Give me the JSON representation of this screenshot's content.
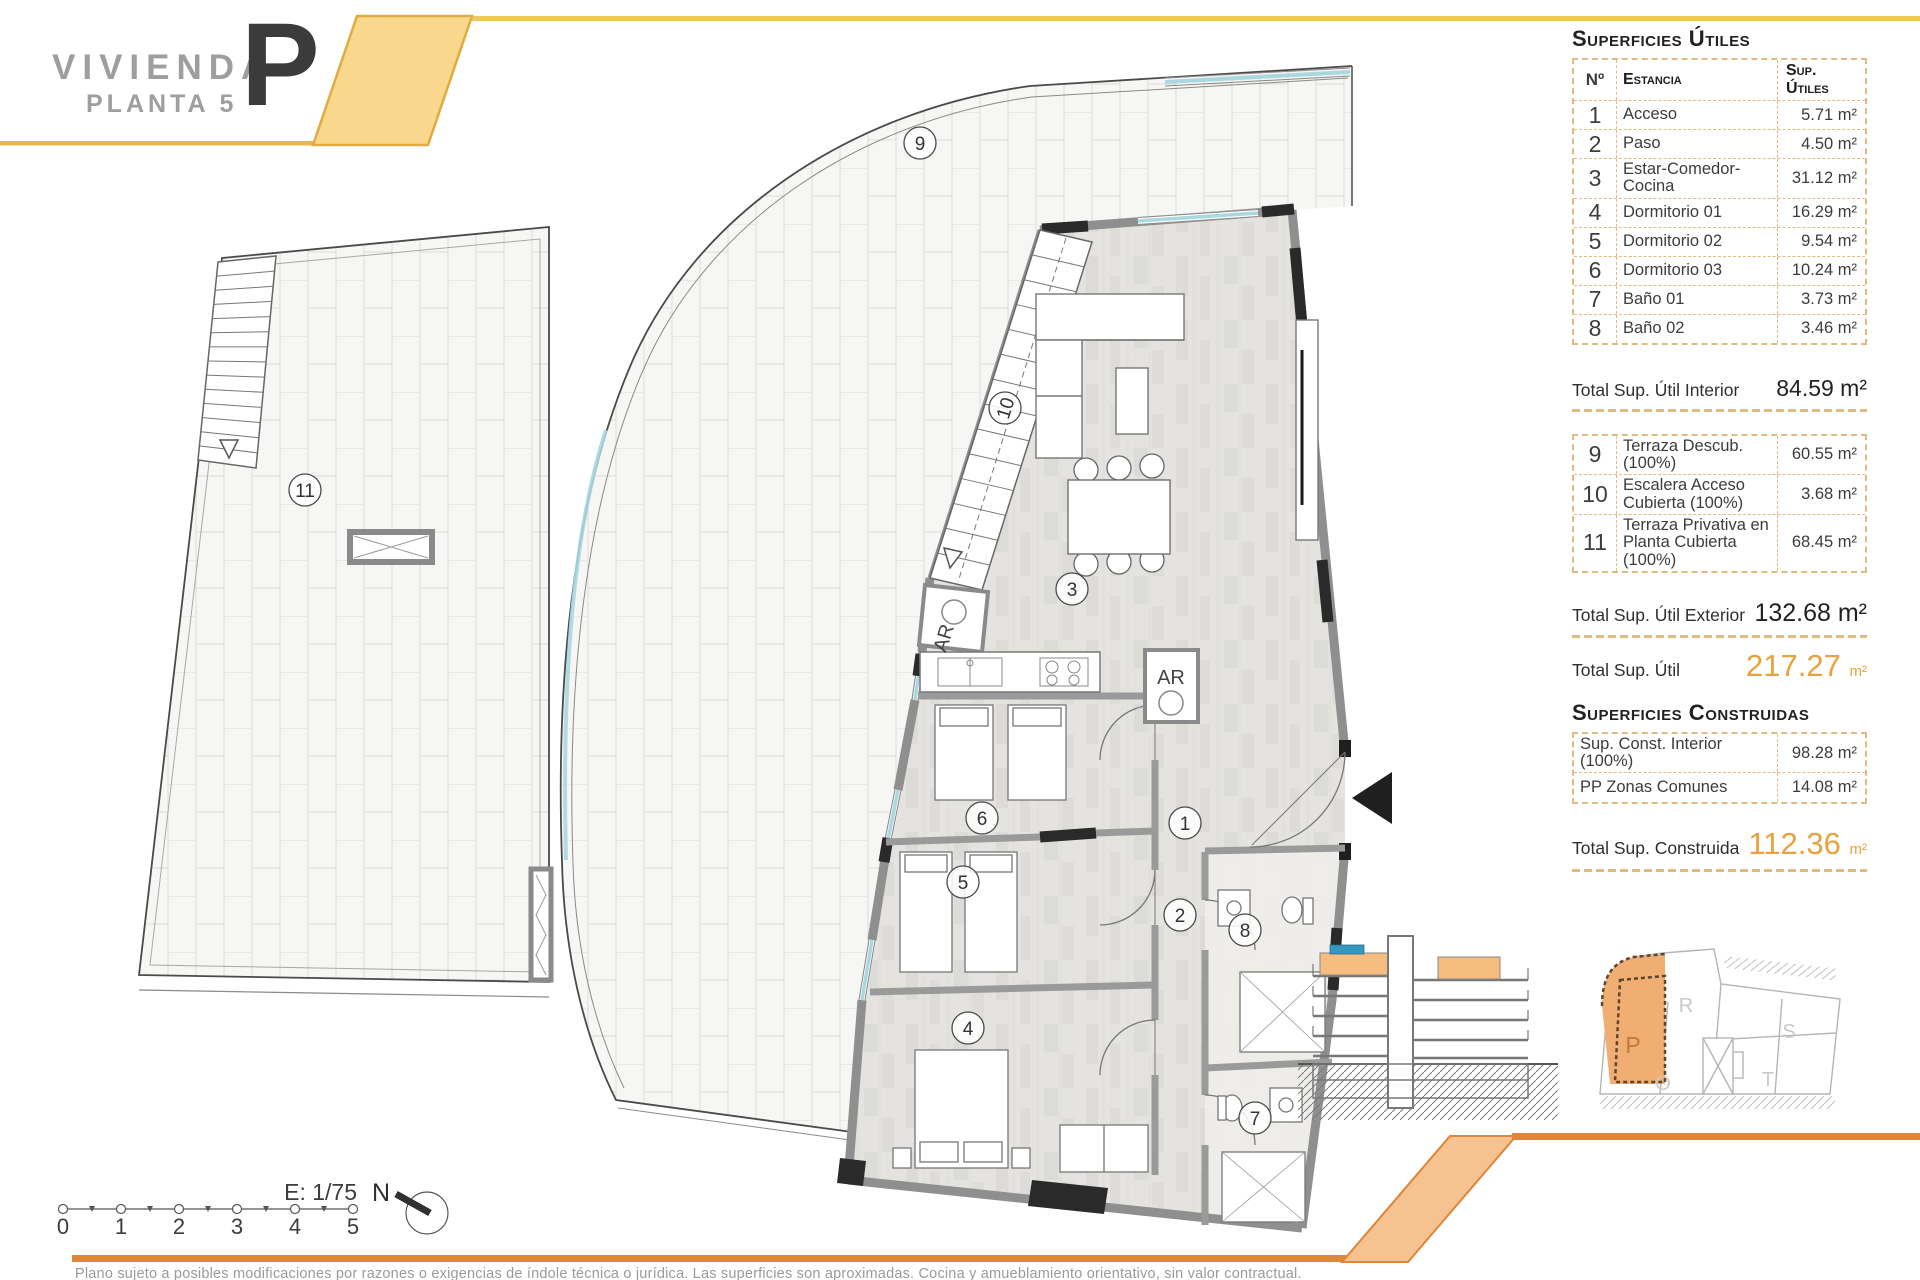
{
  "title": {
    "project": "VIVIENDA",
    "floor": "PLANTA 5",
    "unit_letter": "P"
  },
  "tables": {
    "utiles": {
      "title": "Superficies Útiles",
      "headers": {
        "num": "Nº",
        "room": "Estancia",
        "area": "Sup. Útiles"
      },
      "rows": [
        {
          "num": "1",
          "room": "Acceso",
          "area": "5.71 m²"
        },
        {
          "num": "2",
          "room": "Paso",
          "area": "4.50 m²"
        },
        {
          "num": "3",
          "room": "Estar-Comedor-Cocina",
          "area": "31.12 m²"
        },
        {
          "num": "4",
          "room": "Dormitorio 01",
          "area": "16.29 m²"
        },
        {
          "num": "5",
          "room": "Dormitorio 02",
          "area": "9.54 m²"
        },
        {
          "num": "6",
          "room": "Dormitorio 03",
          "area": "10.24 m²"
        },
        {
          "num": "7",
          "room": "Baño 01",
          "area": "3.73 m²"
        },
        {
          "num": "8",
          "room": "Baño 02",
          "area": "3.46 m²"
        }
      ],
      "total_interior": {
        "label": "Total Sup. Útil Interior",
        "value": "84.59 m²"
      },
      "exterior_rows": [
        {
          "num": "9",
          "room": "Terraza Descub.(100%)",
          "area": "60.55 m²"
        },
        {
          "num": "10",
          "room": "Escalera Acceso Cubierta (100%)",
          "area": "3.68 m²"
        },
        {
          "num": "11",
          "room": "Terraza Privativa en Planta Cubierta (100%)",
          "area": "68.45 m²"
        }
      ],
      "total_exterior": {
        "label": "Total Sup. Útil Exterior",
        "value": "132.68 m²"
      },
      "total": {
        "label": "Total Sup. Útil",
        "value": "217.27",
        "unit": "m²"
      }
    },
    "construidas": {
      "title": "Superficies Construidas",
      "rows": [
        {
          "room": "Sup. Const. Interior (100%)",
          "area": "98.28 m²"
        },
        {
          "room": "PP Zonas Comunes",
          "area": "14.08 m²"
        }
      ],
      "total": {
        "label": "Total Sup. Construida",
        "value": "112.36",
        "unit": "m²"
      }
    }
  },
  "plan": {
    "markers": [
      {
        "id": "1",
        "x": 1185,
        "y": 823
      },
      {
        "id": "2",
        "x": 1180,
        "y": 915
      },
      {
        "id": "3",
        "x": 1072,
        "y": 589
      },
      {
        "id": "4",
        "x": 968,
        "y": 1028
      },
      {
        "id": "5",
        "x": 963,
        "y": 882
      },
      {
        "id": "6",
        "x": 982,
        "y": 818
      },
      {
        "id": "7",
        "x": 1255,
        "y": 1118
      },
      {
        "id": "8",
        "x": 1245,
        "y": 930
      },
      {
        "id": "9",
        "x": 920,
        "y": 143
      },
      {
        "id": "10",
        "x": 1005,
        "y": 408,
        "rotate": -73
      },
      {
        "id": "11",
        "x": 305,
        "y": 490
      }
    ],
    "closet_labels": [
      {
        "text": "AR",
        "x": 950,
        "y": 640,
        "rotate": -73
      },
      {
        "text": "AR",
        "x": 1171,
        "y": 684,
        "rotate": 0
      }
    ],
    "scale": {
      "label": "E: 1/75",
      "ticks": [
        "0",
        "1",
        "2",
        "3",
        "4",
        "5"
      ]
    },
    "north_label": "N",
    "site_plan": {
      "units": [
        {
          "id": "P",
          "x": 1633,
          "y": 1053,
          "highlight": true
        },
        {
          "id": "R",
          "x": 1686,
          "y": 1012,
          "highlight": false
        },
        {
          "id": "S",
          "x": 1789,
          "y": 1038,
          "highlight": false
        },
        {
          "id": "T",
          "x": 1768,
          "y": 1086,
          "highlight": false
        },
        {
          "id": "O",
          "x": 1663,
          "y": 1090,
          "highlight": false
        }
      ]
    }
  },
  "footer": {
    "disclaimer": "Plano sujeto a posibles modificaciones por razones o exigencias de índole técnica o jurídica. Las superficies son aproximadas. Cocina y amueblamiento orientativo, sin valor contractual."
  },
  "colors": {
    "accent_yellow": "#f9d78c",
    "yellow_line": "#efc75f",
    "gold_line": "#e3b84f",
    "orange_bar": "#dc873c",
    "orange_band": "#f6c28f",
    "table_dash": "#e0ba80",
    "total_orange": "#e8a23d",
    "glazing_teal": "#a9d8e0",
    "site_highlight": "#f1ae72",
    "section_pool_blue": "#3598be"
  }
}
